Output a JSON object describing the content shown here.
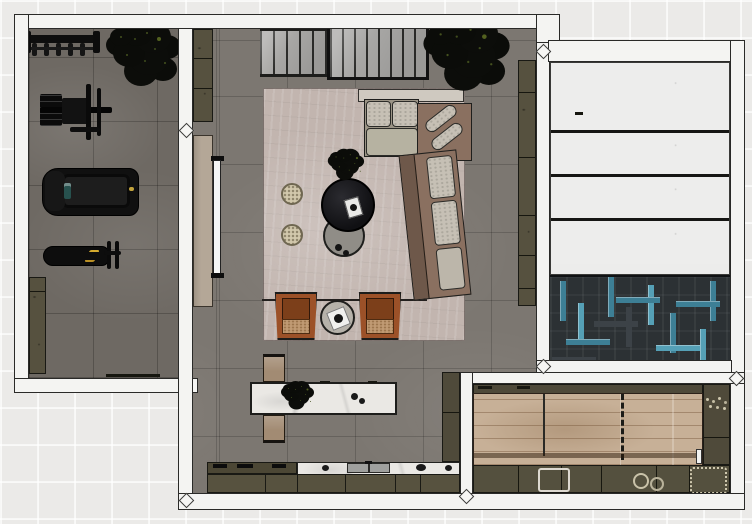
{
  "meta": {
    "type": "interior-floor-plan-rendering",
    "view": "top-down",
    "visible_text": "none"
  },
  "palette": {
    "exterior_tile": "#ebeae8",
    "wall": "#f4f4f2",
    "gym_floor": "#6e6963",
    "living_floor": "#7c7771",
    "rug": "#c2b5af",
    "sofa_cushion": "#c6c0b5",
    "sofa_base": "#8a7060",
    "armchair_leather": "#9c5128",
    "armchair_cushion": "#c09a73",
    "coffee_table_dark": "#1b1b1d",
    "coffee_table_gray": "#908d87",
    "pouf": "#d2c8ac",
    "olive_cabinet": "#56513f",
    "media_wall": "#b4a797",
    "marble": "#eae8e4",
    "bench_tan": "#a28b73",
    "annex_panel": "#ededec",
    "herringbone_base": "#2c3134",
    "herringbone_teal": "#3d7f95",
    "wood_floor": "#c7b097",
    "plant_foliage": "#0b0c09",
    "treadmill_screen": "#27514e",
    "accent_yellow": "#c2a33c"
  },
  "rooms": [
    {
      "id": "gym",
      "floor": "dark-gray-tile",
      "furniture": [
        "dumbbell-rack",
        "potted-tree",
        "cable-machine",
        "treadmill",
        "weight-bench",
        "sideboard"
      ]
    },
    {
      "id": "living-room",
      "floor": "gray-tile",
      "furniture": [
        "slatted-partition",
        "slatted-partition-framed",
        "tall-plant",
        "media-cabinet",
        "media-wall",
        "tv",
        "sofa-console",
        "sectional-sofa",
        "corner-pillows",
        "chaise",
        "coffee-table-dark",
        "coffee-table-gray",
        "table-plant",
        "tray",
        "pouf",
        "pouf",
        "armchair",
        "armchair",
        "side-table",
        "area-rug",
        "wall-cabinet-run"
      ]
    },
    {
      "id": "kitchen",
      "floor": "gray-tile",
      "furniture": [
        "marble-island",
        "island-centerpiece",
        "bench",
        "bench",
        "cooktop-counter",
        "marble-counter",
        "sink",
        "base-cabinets",
        "tall-cabinet"
      ]
    },
    {
      "id": "right-annex",
      "floor": "dark-teal-herringbone",
      "features": [
        "white-panel-sections-x4"
      ]
    },
    {
      "id": "rec-room",
      "floor": "light-wood-plank",
      "features": [
        "perimeter-cabinets",
        "lane-marking-dashed",
        "lane-marking-solid",
        "counter-trays"
      ]
    }
  ]
}
